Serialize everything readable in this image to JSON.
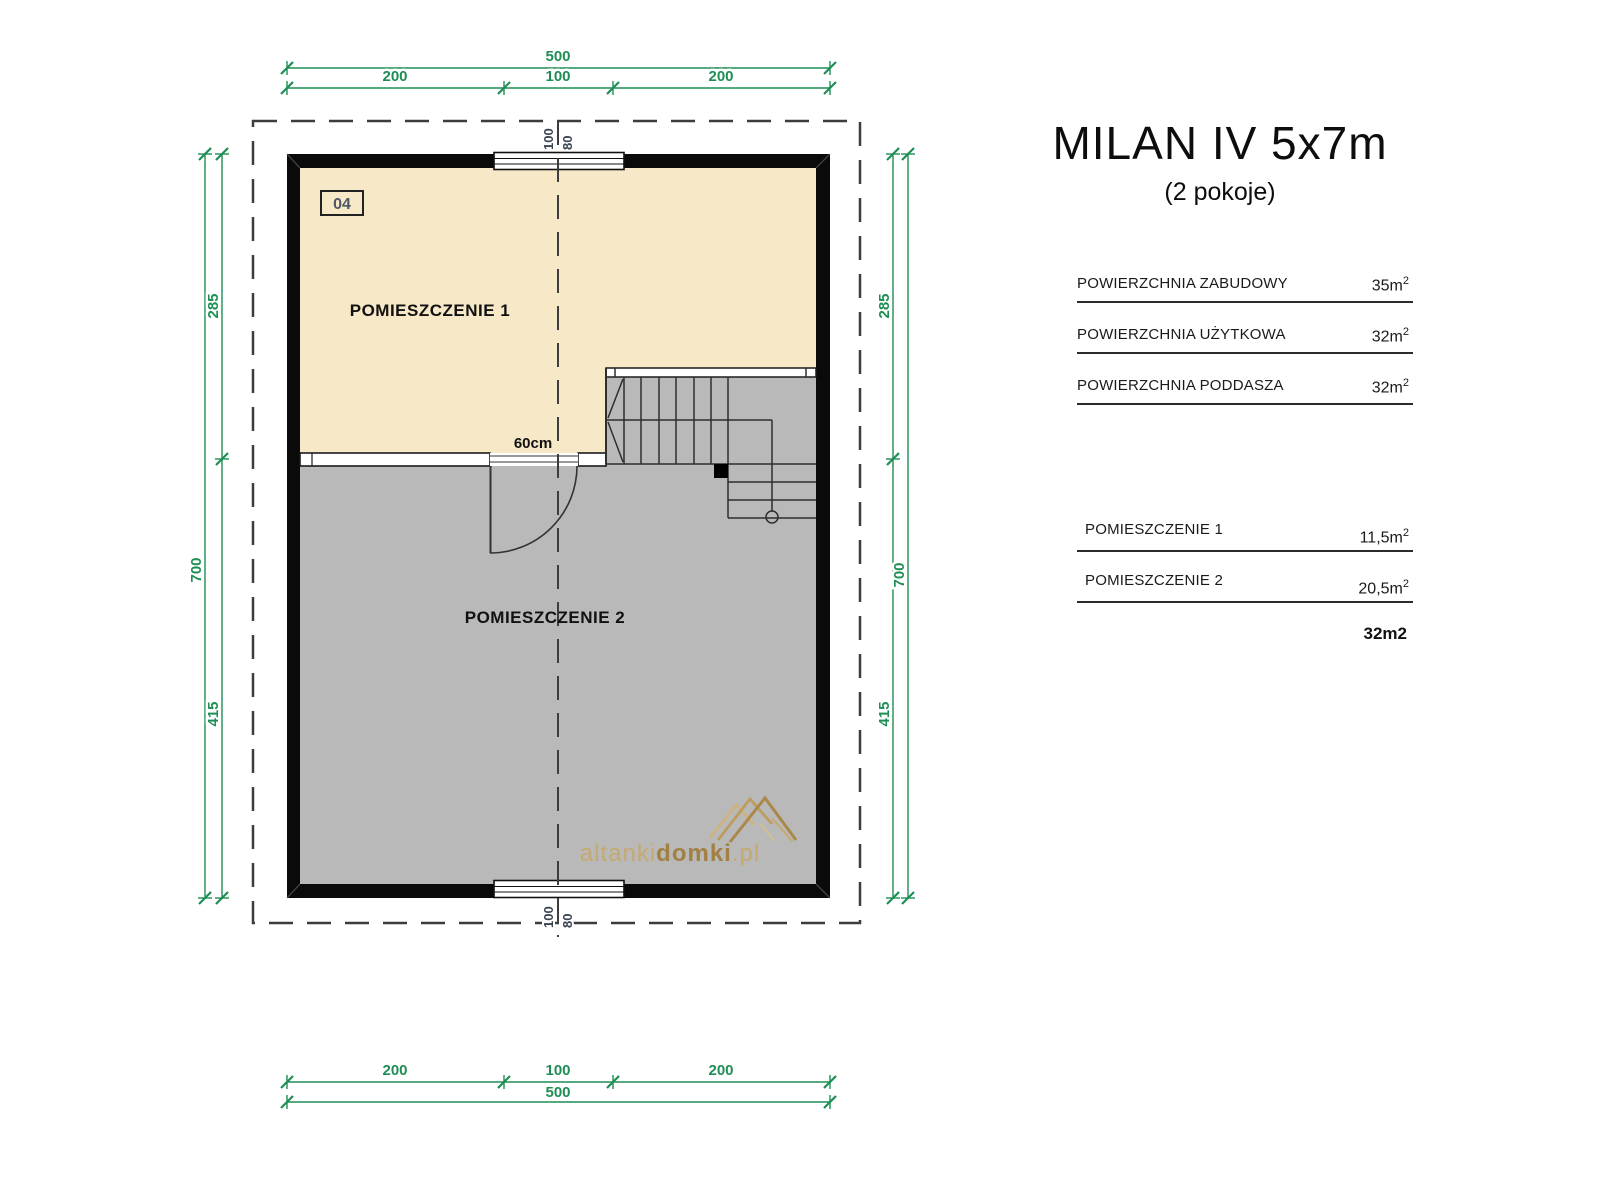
{
  "title": {
    "main": "MILAN IV 5x7m",
    "sub": "(2 pokoje)"
  },
  "summary": {
    "rows": [
      {
        "label": "POWIERZCHNIA ZABUDOWY",
        "value": "35m",
        "sup": "2"
      },
      {
        "label": "POWIERZCHNIA UŻYTKOWA",
        "value": "32m",
        "sup": "2"
      },
      {
        "label": "POWIERZCHNIA PODDASZA",
        "value": "32m",
        "sup": "2"
      }
    ]
  },
  "rooms": {
    "rows": [
      {
        "label": "POMIESZCZENIE 1",
        "value": "11,5m",
        "sup": "2"
      },
      {
        "label": "POMIESZCZENIE 2",
        "value": "20,5m",
        "sup": "2"
      }
    ],
    "total": "32m2"
  },
  "plan": {
    "unit_badge": "04",
    "room1_label": "POMIESZCZENIE 1",
    "room2_label": "POMIESZCZENIE 2",
    "door_label": "60cm",
    "watermark": {
      "part1": "altanki",
      "part2": "domki",
      "part3": ".pl"
    },
    "dims": {
      "total_width": "500",
      "seg_left": "200",
      "seg_center": "100",
      "seg_right": "200",
      "total_height": "700",
      "seg_upper": "285",
      "seg_lower": "415",
      "window_width": "100",
      "window_height": "80"
    }
  },
  "colors": {
    "dimension_green": "#1e8e55",
    "room1_fill": "#f7e8c7",
    "room2_fill": "#b9b9b9",
    "wall": "#0a0a0a",
    "watermark_gold": "#b08a46"
  }
}
